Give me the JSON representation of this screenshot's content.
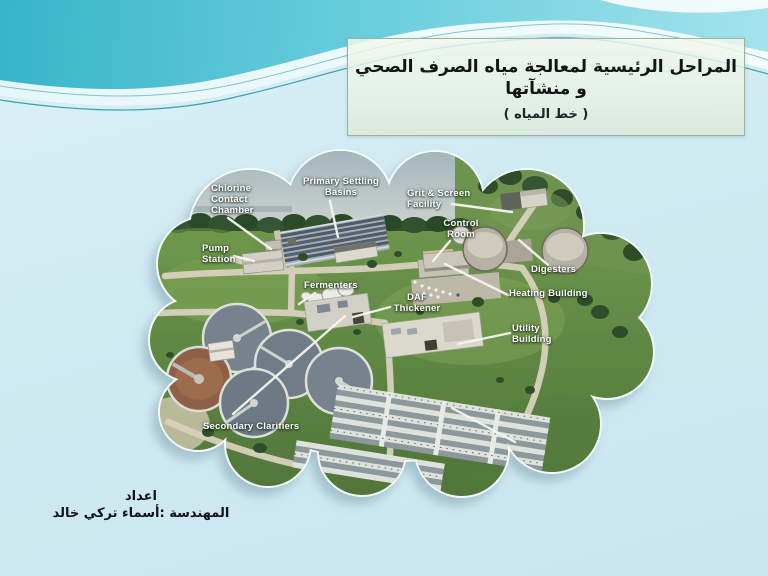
{
  "title": {
    "line1": "المراحل الرئيسية لمعالجة مياه الصرف الصحي و منشآتها",
    "line2": "( خط المياه )"
  },
  "credit": {
    "line1": "اعداد",
    "line2": "المهندسة :أسماء تركي خالد"
  },
  "figure": {
    "labels": [
      {
        "id": "chlorine-contact-chamber",
        "text": "Chlorine\nContact\nChamber"
      },
      {
        "id": "primary-settling-basins",
        "text": "Primary Settling\nBasins"
      },
      {
        "id": "grit-screen-facility",
        "text": "Grit & Screen\nFacility"
      },
      {
        "id": "control-room",
        "text": "Control\nRoom"
      },
      {
        "id": "pump-station",
        "text": "Pump\nStation"
      },
      {
        "id": "fermenters",
        "text": "Fermenters"
      },
      {
        "id": "daf-thickener",
        "text": "DAF\nThickener"
      },
      {
        "id": "digesters",
        "text": "Digesters"
      },
      {
        "id": "heating-building",
        "text": "Heating Building"
      },
      {
        "id": "utility-building",
        "text": "Utility\nBuilding"
      },
      {
        "id": "secondary-clarifiers",
        "text": "Secondary Clarifiers"
      }
    ]
  },
  "colors": {
    "band_teal": "#3ab6cb",
    "background_blue": "#d0eaf2",
    "title_box_fill": "#edf4e9",
    "label_text": "#ffffff",
    "grass": "#6e9450",
    "road": "#d7d1bd"
  }
}
